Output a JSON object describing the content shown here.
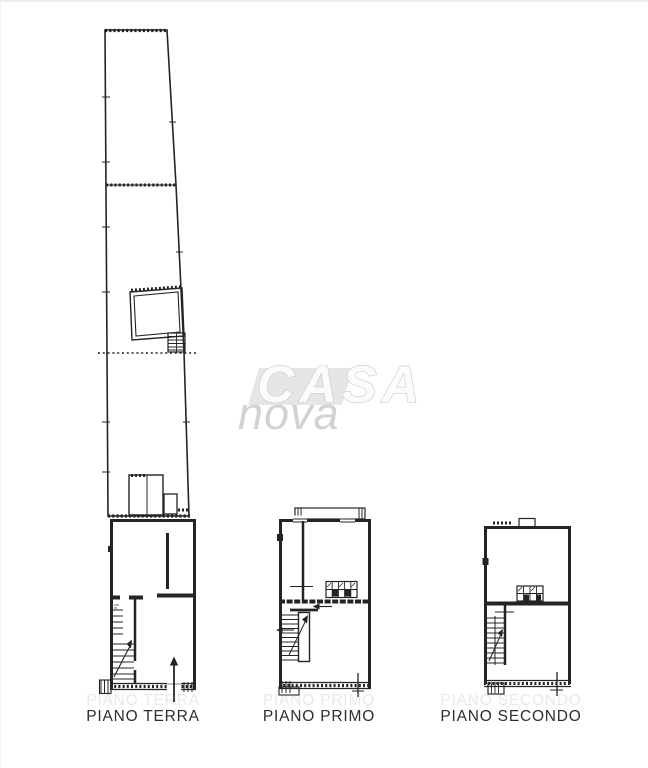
{
  "colors": {
    "ink": "#242424",
    "paper": "#ffffff",
    "label": "#2e2e2e",
    "watermark_slab": "#e6e6e6",
    "watermark_outline": "#cccccc",
    "watermark_fill": "#fbfbfb",
    "watermark_nova": "#d2d2d2"
  },
  "watermark": {
    "line1": "CASA",
    "line2": "nova"
  },
  "floor_labels": [
    {
      "id": "terra",
      "label": "PIANO TERRA"
    },
    {
      "id": "primo",
      "label": "PIANO PRIMO"
    },
    {
      "id": "secondo",
      "label": "PIANO SECONDO"
    }
  ]
}
